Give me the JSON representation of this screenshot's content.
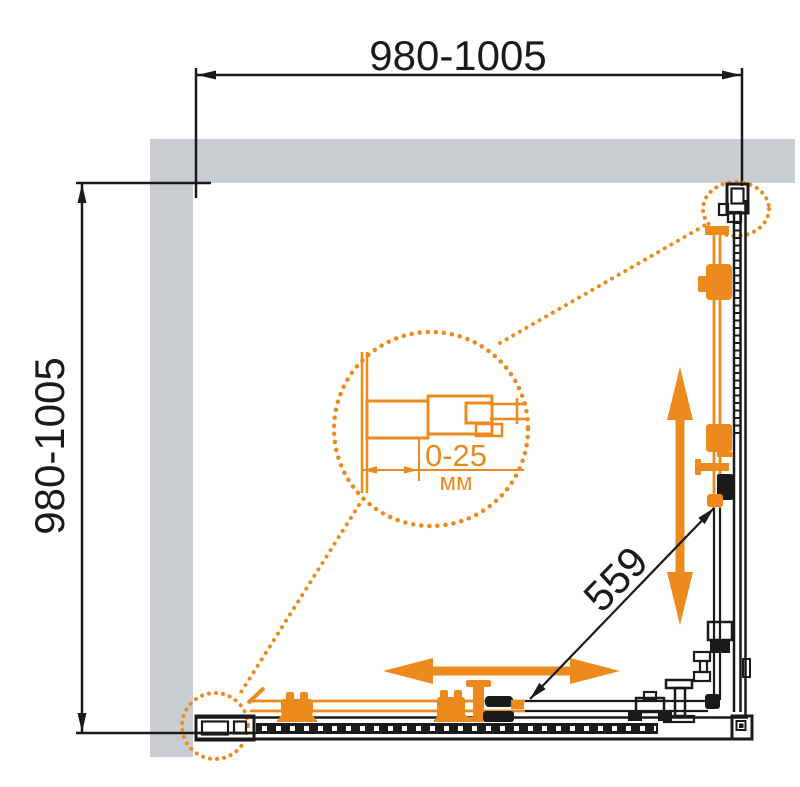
{
  "drawing": {
    "title": "shower enclosure dimension drawing",
    "top_dimension": "980-1005",
    "left_dimension": "980-1005",
    "diagonal_dimension": "559",
    "detail": {
      "range": "0-25",
      "unit": "мм"
    },
    "colors": {
      "accent_orange": "#ED8A1E",
      "wall_gray": "#C9CDD1",
      "line_black": "#1A1A1A"
    }
  }
}
